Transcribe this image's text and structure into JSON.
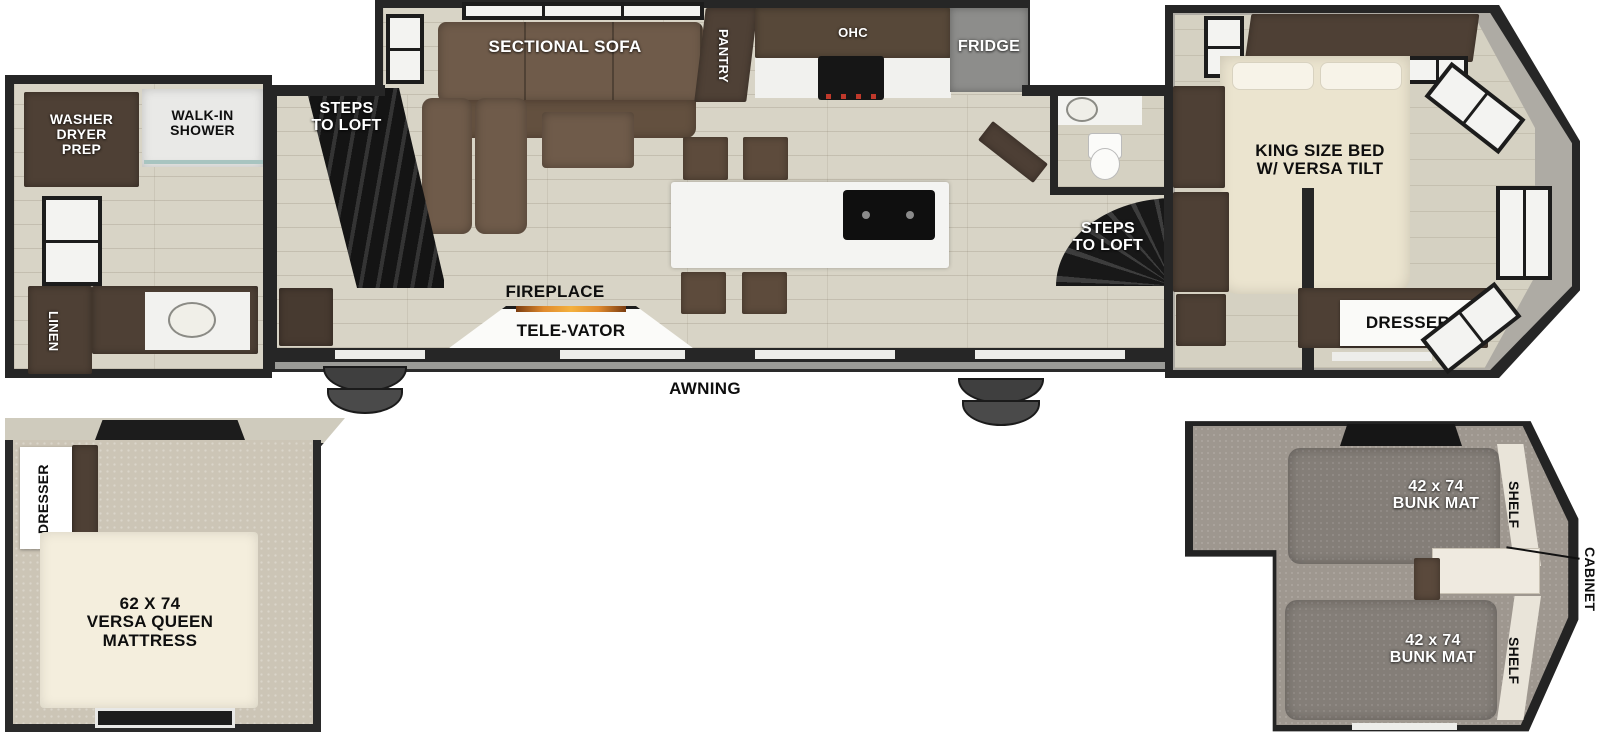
{
  "floorplan": {
    "bathroom": {
      "washer_dryer_prep": "WASHER\nDRYER\nPREP",
      "walk_in_shower": "WALK-IN\nSHOWER",
      "linen": "LINEN"
    },
    "living": {
      "steps_to_loft": "STEPS\nTO LOFT",
      "sectional_sofa": "SECTIONAL SOFA",
      "fireplace": "FIREPLACE",
      "televator": "TELE-VATOR"
    },
    "kitchen": {
      "pantry": "PANTRY",
      "ohc": "OHC",
      "fridge": "FRIDGE"
    },
    "hall": {
      "steps_to_loft": "STEPS\nTO LOFT"
    },
    "master_bedroom": {
      "bed": "KING SIZE BED\nW/ VERSA TILT",
      "dresser": "DRESSER"
    },
    "exterior": {
      "awning": "AWNING"
    },
    "queen_loft": {
      "dresser": "DRESSER",
      "mattress": "62 X 74\nVERSA QUEEN\nMATTRESS"
    },
    "bunk_loft": {
      "bunk_top": "42 x 74\nBUNK MAT",
      "bunk_bottom": "42 x 74\nBUNK MAT",
      "shelf_top": "SHELF",
      "shelf_bottom": "SHELF",
      "cabinet": "CABINET"
    }
  },
  "colors": {
    "wall": "#262626",
    "floor_wood": "#d8d4c6",
    "cabinet_dark": "#4e4035",
    "sofa_brown": "#6f5b4a",
    "island_white": "#f4f4f2",
    "fridge_gray": "#8d8d8b",
    "cap_gray": "#aeaba4",
    "loft_carpet": "#9e978f",
    "bunk_mat": "#847e78",
    "mattress_cream": "#f4eedd",
    "bed_cream": "#ebe4cf",
    "flame_orange": "#e08a2e",
    "awning_rail": "#9b9b97"
  }
}
